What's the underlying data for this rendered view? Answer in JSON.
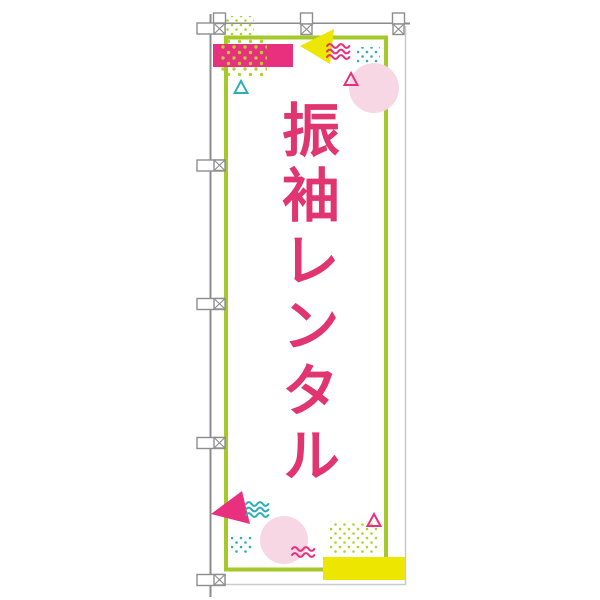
{
  "page": {
    "background": "#ffffff"
  },
  "banner": {
    "text": "振袖レンタル",
    "orientation": "vertical"
  },
  "colors": {
    "text_pink": "#e0356f",
    "shape_magenta": "#e8307f",
    "lime_green": "#a5c82a",
    "lime_dots": "#aed42c",
    "yellow": "#ece600",
    "teal": "#2fadbc",
    "light_pink": "#f8d7e5",
    "pole_gray": "#8c8c8c",
    "shadow_gray": "#c9c9c9",
    "fabric_white": "#ffffff"
  },
  "hardware": {
    "top_tab_count": 3,
    "side_tab_count": 5
  }
}
